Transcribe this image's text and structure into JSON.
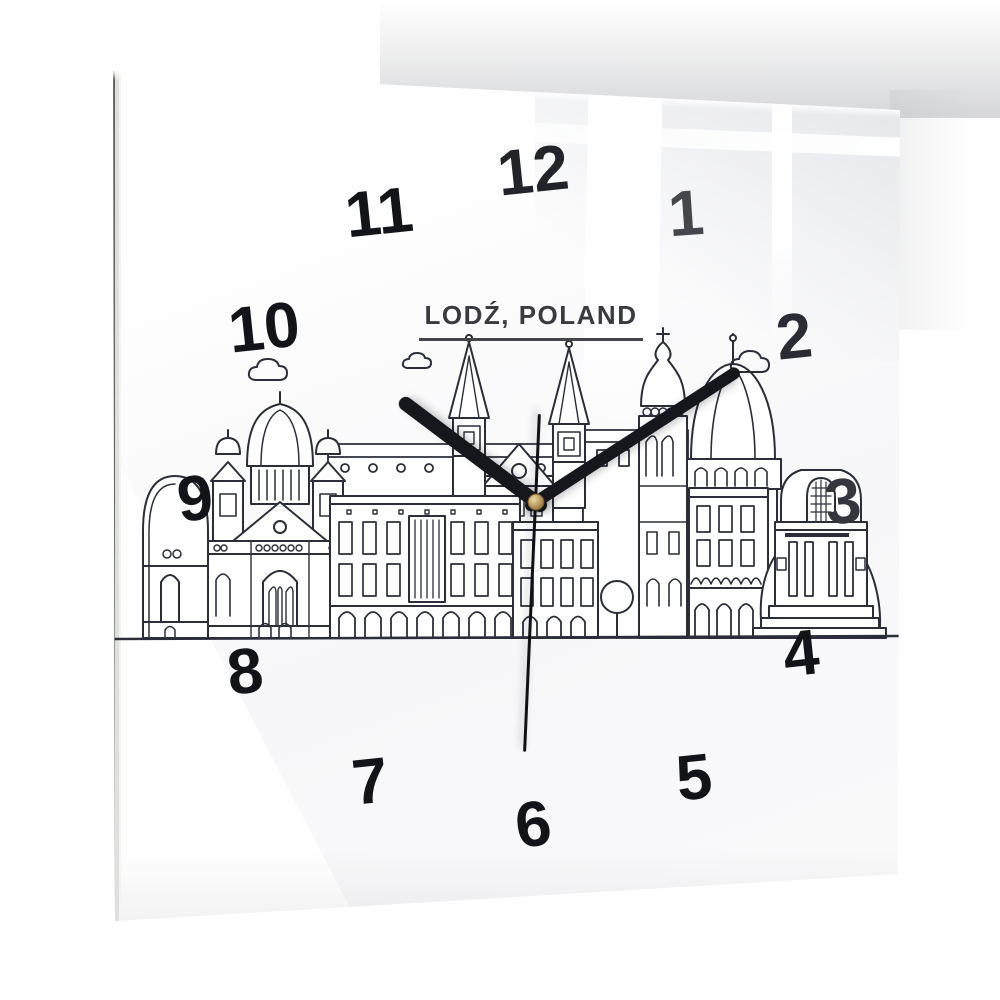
{
  "scene": {
    "description": "Square glass wall clock hanging on a white wall with window reflections on the glass"
  },
  "clock": {
    "city_label": "LODŹ, POLAND",
    "illustration": "lodz-city-skyline-line-art",
    "displayed_time": "10:09:30",
    "numerals": [
      {
        "label": "12"
      },
      {
        "label": "1"
      },
      {
        "label": "2"
      },
      {
        "label": "3"
      },
      {
        "label": "4"
      },
      {
        "label": "5"
      },
      {
        "label": "6"
      },
      {
        "label": "7"
      },
      {
        "label": "8"
      },
      {
        "label": "9"
      },
      {
        "label": "10"
      },
      {
        "label": "11"
      }
    ],
    "colors": {
      "panel": "#fdfdfe",
      "numeral": "#131419",
      "artwork_line": "#2b2e3a",
      "hands": "#16171c",
      "center_pin_gold": "#b2925c"
    }
  }
}
